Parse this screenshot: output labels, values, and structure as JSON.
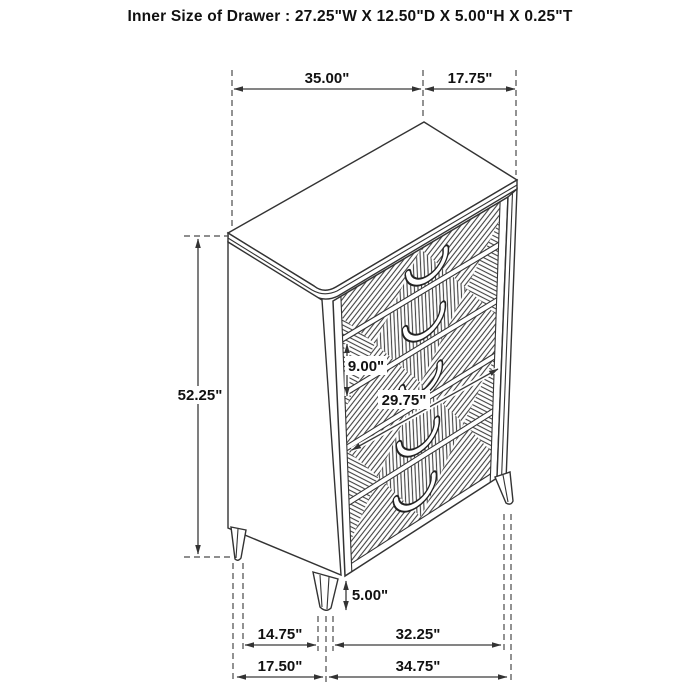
{
  "title": "Inner Size of Drawer : 27.25\"W X 12.50\"D X 5.00\"H X 0.25\"T",
  "dims": {
    "top_width": "35.00\"",
    "top_depth": "17.75\"",
    "overall_height": "52.25\"",
    "drawer_front_height": "9.00\"",
    "drawer_front_width": "29.75\"",
    "leg_height": "5.00\"",
    "base_inner_depth": "14.75\"",
    "base_inner_width": "32.25\"",
    "base_depth": "17.50\"",
    "base_width": "34.75\""
  },
  "figure": {
    "drawer_count": 5
  },
  "colors": {
    "background": "#ffffff",
    "line": "#3a3a3a",
    "text": "#111111"
  }
}
